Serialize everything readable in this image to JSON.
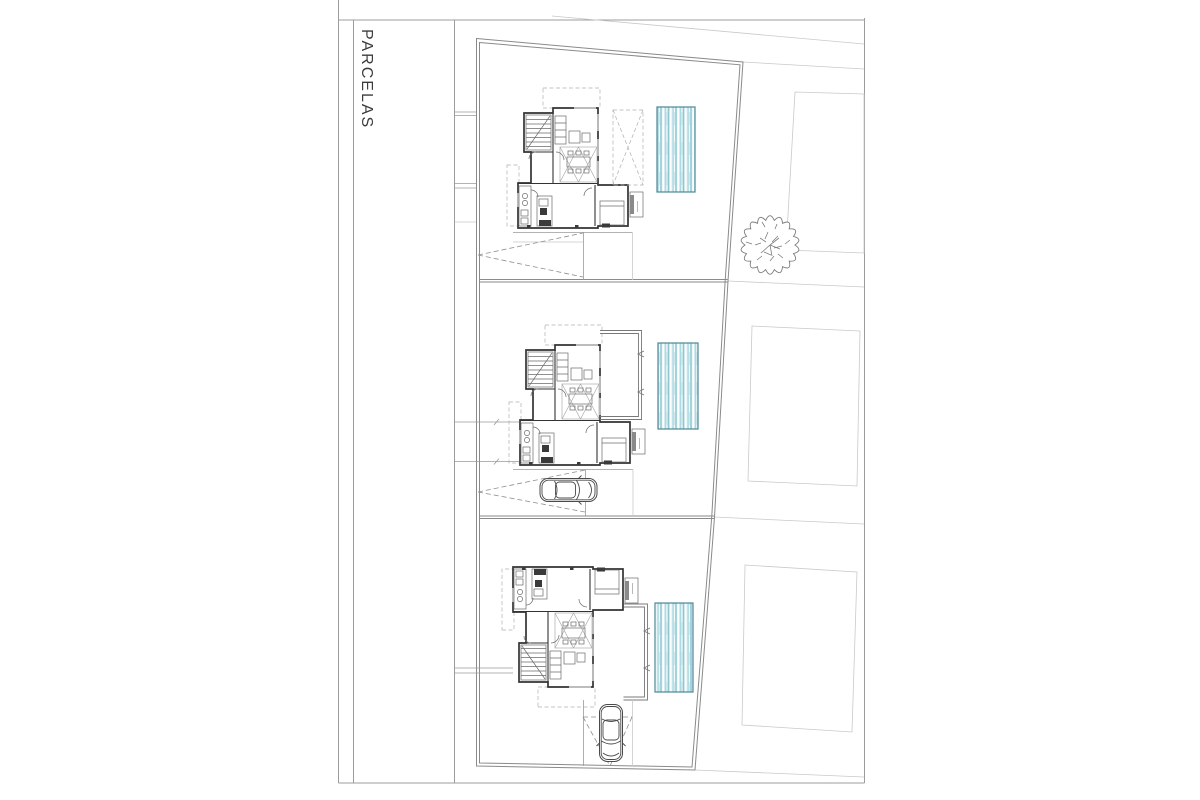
{
  "sheet": {
    "title": "PARCELAS",
    "width_px": 1200,
    "height_px": 800,
    "background": "#ffffff",
    "type": "architectural-site-plan"
  },
  "colors": {
    "frame_line": "#9c9c9c",
    "boundary_line": "#8a8a8a",
    "lot_line": "#9a9a9a",
    "wall_line": "#333333",
    "detail_line": "#6b6b6b",
    "faint_line": "#c9c9c9",
    "dashed_line": "#b0b0b0",
    "sight_line": "#8f8f8f",
    "pool_border": "#4d8795",
    "pool_fill": "#cfe9ee",
    "pool_stripe_dark": "#8fc7d1",
    "pool_stripe_mid": "#a9d8e0",
    "pool_stripe_white": "#ffffff",
    "tree_line": "#7d7d7d",
    "car_line": "#4a4a4a",
    "title_text": "#3b3b3b"
  },
  "parcels": [
    {
      "id": 1,
      "label": "parcel-1",
      "contents": [
        "house-floor-plan",
        "dashed-carport-roof",
        "swimming-pool",
        "driveway-sight-lines"
      ]
    },
    {
      "id": 2,
      "label": "parcel-2",
      "contents": [
        "house-floor-plan",
        "walled-terrace",
        "swimming-pool",
        "parked-car",
        "driveway-sight-lines"
      ]
    },
    {
      "id": 3,
      "label": "parcel-3",
      "contents": [
        "house-floor-plan-mirrored",
        "walled-terrace",
        "swimming-pool",
        "parked-car",
        "driveway-sight-lines"
      ]
    }
  ],
  "surroundings": {
    "neighbor_plots": 3,
    "tree_count": 1,
    "road_lines": 2
  }
}
